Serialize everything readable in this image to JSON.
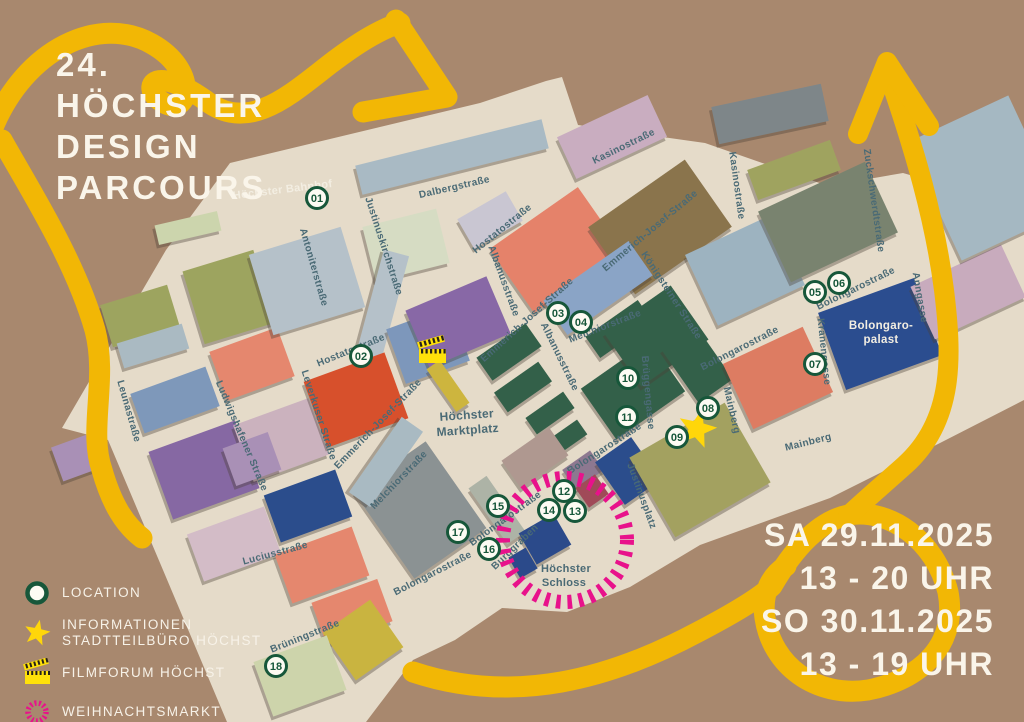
{
  "title": {
    "line1": "24.",
    "line2": "HÖCHSTER",
    "line3": "DESIGN",
    "line4": "PARCOURS"
  },
  "dates": {
    "day1": "SA 29.11.2025",
    "time1": "13 - 20 UHR",
    "day2": "SO 30.11.2025",
    "time2": "13 - 19 UHR"
  },
  "legend": {
    "items": [
      {
        "icon": "location-circle",
        "label": "LOCATION"
      },
      {
        "icon": "star",
        "label": "INFORMATIONEN",
        "label2": "STADTTEILBÜRO HÖCHST"
      },
      {
        "icon": "film-clapper",
        "label": "FILMFORUM HÖCHST"
      },
      {
        "icon": "dotted-circle",
        "label": "WEIHNACHTSMARKT"
      }
    ]
  },
  "colors": {
    "background": "#a8886e",
    "map_base": "#e5dbc9",
    "route_yellow": "#f2b705",
    "christmas_pink": "#e8128b",
    "marker_green": "#17573a",
    "street_text": "#4a6a75",
    "star_yellow": "#ffd60a",
    "clapper_yellow": "#ffe10a",
    "text_white": "#faf5ea"
  },
  "map": {
    "places": [
      [
        "Höchster Bahnhof",
        283,
        193,
        -7,
        11,
        "#f3eee2"
      ],
      [
        "Höchster",
        467,
        419,
        -4,
        12,
        "#4a6a75"
      ],
      [
        "Marktplatz",
        468,
        434,
        -4,
        12,
        "#4a6a75"
      ],
      [
        "Höchster",
        566,
        572,
        0,
        11,
        "#4a6a75"
      ],
      [
        "Schloss",
        564,
        586,
        0,
        11,
        "#4a6a75"
      ],
      [
        "Bolongaro-",
        881,
        329,
        0,
        11.5,
        "#f3eee2"
      ],
      [
        "palast",
        881,
        343,
        0,
        11.5,
        "#f3eee2"
      ]
    ],
    "streets": [
      [
        "Dalbergstraße",
        455,
        190,
        -13
      ],
      [
        "Hostatostraße",
        504,
        231,
        -39
      ],
      [
        "Hostatostraße",
        352,
        353,
        -22
      ],
      [
        "Antoniterstraße",
        311,
        268,
        74
      ],
      [
        "Justinuskirchstraße",
        381,
        247,
        72
      ],
      [
        "Albanusstraße",
        501,
        282,
        70
      ],
      [
        "Albanusstraße",
        557,
        358,
        64
      ],
      [
        "Kasinostraße",
        625,
        149,
        -26
      ],
      [
        "Kasinostraße",
        734,
        186,
        82
      ],
      [
        "Zuckschwerdtstraße",
        871,
        201,
        82
      ],
      [
        "Emmerich-Josef-Straße",
        652,
        233,
        -40
      ],
      [
        "Emmerich-Josef-Straße",
        529,
        322,
        -42
      ],
      [
        "Emmerich-Josef-Straße",
        380,
        426,
        -46
      ],
      [
        "Melchiorstraße",
        606,
        329,
        -21
      ],
      [
        "Melchiorstraße",
        401,
        482,
        -46
      ],
      [
        "Königsteiner Straße",
        669,
        297,
        57
      ],
      [
        "Brüggengasse",
        645,
        393,
        85
      ],
      [
        "Bolongarostraße",
        857,
        291,
        -26
      ],
      [
        "Bolongarostraße",
        741,
        351,
        -27
      ],
      [
        "Bolongarostraße",
        606,
        451,
        -33
      ],
      [
        "Bolongarostraße",
        507,
        521,
        -36
      ],
      [
        "Bolongarostraße",
        434,
        576,
        -27
      ],
      [
        "Kranengasse",
        821,
        352,
        84
      ],
      [
        "Anngasse",
        917,
        298,
        80
      ],
      [
        "Mainberg",
        729,
        411,
        77
      ],
      [
        "Mainberg",
        809,
        445,
        -14
      ],
      [
        "Leunastraße",
        126,
        412,
        74
      ],
      [
        "Ludwigshafener Straße",
        239,
        437,
        67
      ],
      [
        "Leverkuser Straße",
        316,
        416,
        72
      ],
      [
        "Luciusstraße",
        276,
        556,
        -15
      ],
      [
        "Brüningstraße",
        306,
        639,
        -22
      ],
      [
        "Burggraben",
        517,
        549,
        -44
      ],
      [
        "Justinusplatz",
        639,
        497,
        70
      ]
    ],
    "markers": [
      [
        "01",
        317,
        198
      ],
      [
        "02",
        361,
        356
      ],
      [
        "03",
        558,
        313
      ],
      [
        "04",
        581,
        322
      ],
      [
        "05",
        815,
        292
      ],
      [
        "06",
        839,
        283
      ],
      [
        "07",
        815,
        364
      ],
      [
        "08",
        708,
        408
      ],
      [
        "09",
        677,
        437
      ],
      [
        "10",
        628,
        378
      ],
      [
        "11",
        627,
        417
      ],
      [
        "12",
        564,
        491
      ],
      [
        "13",
        575,
        511
      ],
      [
        "14",
        549,
        510
      ],
      [
        "15",
        498,
        506
      ],
      [
        "16",
        489,
        549
      ],
      [
        "17",
        458,
        532
      ],
      [
        "18",
        276,
        666
      ]
    ],
    "buildings": [
      [
        188,
        228,
        64,
        20,
        -13,
        "#ccd5ad"
      ],
      [
        452,
        157,
        192,
        30,
        -14,
        "#a9bac4"
      ],
      [
        406,
        245,
        76,
        56,
        -14,
        "#d6dcc3"
      ],
      [
        490,
        220,
        56,
        34,
        -30,
        "#c9c6d2"
      ],
      [
        612,
        137,
        100,
        46,
        -25,
        "#c9adc0"
      ],
      [
        140,
        316,
        70,
        44,
        -17,
        "#9da45f"
      ],
      [
        229,
        297,
        74,
        76,
        -17,
        "#9da45f"
      ],
      [
        153,
        346,
        68,
        26,
        -17,
        "#aabac2"
      ],
      [
        252,
        364,
        72,
        52,
        -20,
        "#e5876e"
      ],
      [
        307,
        281,
        96,
        84,
        -17,
        "#b5c1c9"
      ],
      [
        382,
        307,
        26,
        112,
        15,
        "#b5c1c9"
      ],
      [
        428,
        345,
        68,
        58,
        -20,
        "#7d97bb"
      ],
      [
        175,
        400,
        80,
        42,
        -20,
        "#7e98ba"
      ],
      [
        204,
        470,
        92,
        72,
        -20,
        "#8668a3"
      ],
      [
        281,
        440,
        80,
        60,
        -20,
        "#cbb2be"
      ],
      [
        356,
        400,
        86,
        70,
        -20,
        "#d7502c"
      ],
      [
        308,
        506,
        76,
        50,
        -20,
        "#2b4d8c"
      ],
      [
        234,
        544,
        82,
        50,
        -20,
        "#d3bcc7"
      ],
      [
        252,
        459,
        48,
        40,
        -20,
        "#a990b6"
      ],
      [
        75,
        458,
        38,
        36,
        -20,
        "#a990b6"
      ],
      [
        322,
        565,
        82,
        52,
        -20,
        "#e5876e"
      ],
      [
        352,
        612,
        70,
        45,
        -20,
        "#e5876e"
      ],
      [
        363,
        640,
        58,
        58,
        -35,
        "#c9b440"
      ],
      [
        300,
        676,
        78,
        58,
        -20,
        "#cdd4ab"
      ],
      [
        420,
        510,
        88,
        106,
        -35,
        "#8b9293"
      ],
      [
        386,
        462,
        26,
        92,
        35,
        "#a9bac2"
      ],
      [
        458,
        322,
        88,
        62,
        -23,
        "#8868a6"
      ],
      [
        556,
        250,
        108,
        78,
        -35,
        "#e5826a"
      ],
      [
        660,
        227,
        118,
        82,
        -35,
        "#8a744c"
      ],
      [
        598,
        288,
        104,
        42,
        -35,
        "#8aa4c6"
      ],
      [
        448,
        386,
        16,
        52,
        -35,
        "#cdb53e"
      ],
      [
        509,
        352,
        60,
        28,
        -35,
        "#336049"
      ],
      [
        523,
        387,
        54,
        24,
        -35,
        "#336049"
      ],
      [
        550,
        413,
        46,
        20,
        -35,
        "#336049"
      ],
      [
        565,
        439,
        42,
        18,
        -35,
        "#336049"
      ],
      [
        619,
        329,
        64,
        26,
        -35,
        "#336049"
      ],
      [
        633,
        390,
        84,
        62,
        -35,
        "#336049"
      ],
      [
        656,
        336,
        82,
        66,
        -35,
        "#336049"
      ],
      [
        697,
        364,
        42,
        66,
        -35,
        "#336049"
      ],
      [
        535,
        458,
        58,
        34,
        -35,
        "#af9890"
      ],
      [
        583,
        470,
        34,
        24,
        -35,
        "#8d7890"
      ],
      [
        628,
        471,
        44,
        52,
        -35,
        "#2b4d8c"
      ],
      [
        592,
        491,
        24,
        24,
        -35,
        "#a04a58"
      ],
      [
        497,
        510,
        22,
        68,
        -35,
        "#adb3a6"
      ],
      [
        545,
        539,
        40,
        36,
        -30,
        "#2b4a8a"
      ],
      [
        523,
        563,
        20,
        24,
        -30,
        "#2b4a8a"
      ],
      [
        700,
        470,
        110,
        92,
        -30,
        "#a3a160"
      ],
      [
        745,
        270,
        96,
        78,
        -25,
        "#9db3c0"
      ],
      [
        770,
        114,
        112,
        38,
        -12,
        "#7e8689"
      ],
      [
        794,
        170,
        88,
        32,
        -20,
        "#9fa35f"
      ],
      [
        828,
        222,
        118,
        78,
        -25,
        "#79836f"
      ],
      [
        778,
        378,
        88,
        72,
        -25,
        "#dd7c62"
      ],
      [
        880,
        334,
        102,
        82,
        -20,
        "#2b4d8f"
      ],
      [
        968,
        292,
        100,
        58,
        -25,
        "#c8abbd"
      ],
      [
        985,
        178,
        112,
        130,
        -25,
        "#a5b8c2"
      ]
    ],
    "info_star": {
      "x": 697,
      "y": 429
    },
    "film_clapper": {
      "x": 432,
      "y": 352
    },
    "christmas_ring": {
      "x": 565,
      "y": 540,
      "r": 62
    }
  }
}
